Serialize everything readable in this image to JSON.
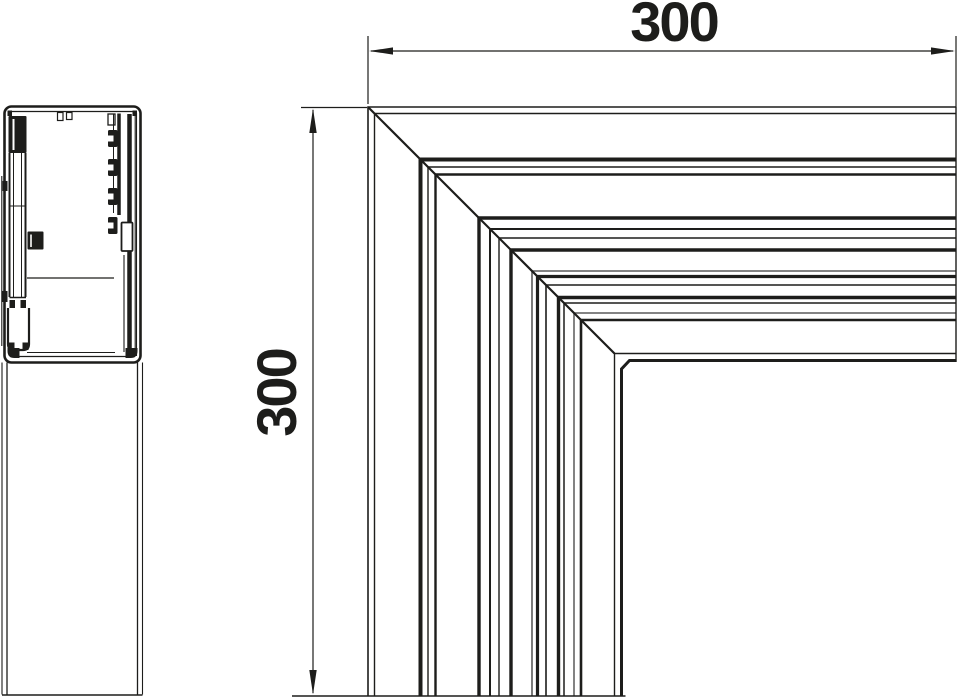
{
  "drawing": {
    "type": "technical-dimension-drawing",
    "background_color": "#ffffff",
    "line_color": "#1d1d1b",
    "views": {
      "left": "trunking-profile-cross-section-side-view",
      "right": "flat-corner-piece-top-view"
    }
  },
  "dimensions": {
    "width": {
      "value": "300"
    },
    "height": {
      "value": "300"
    }
  }
}
